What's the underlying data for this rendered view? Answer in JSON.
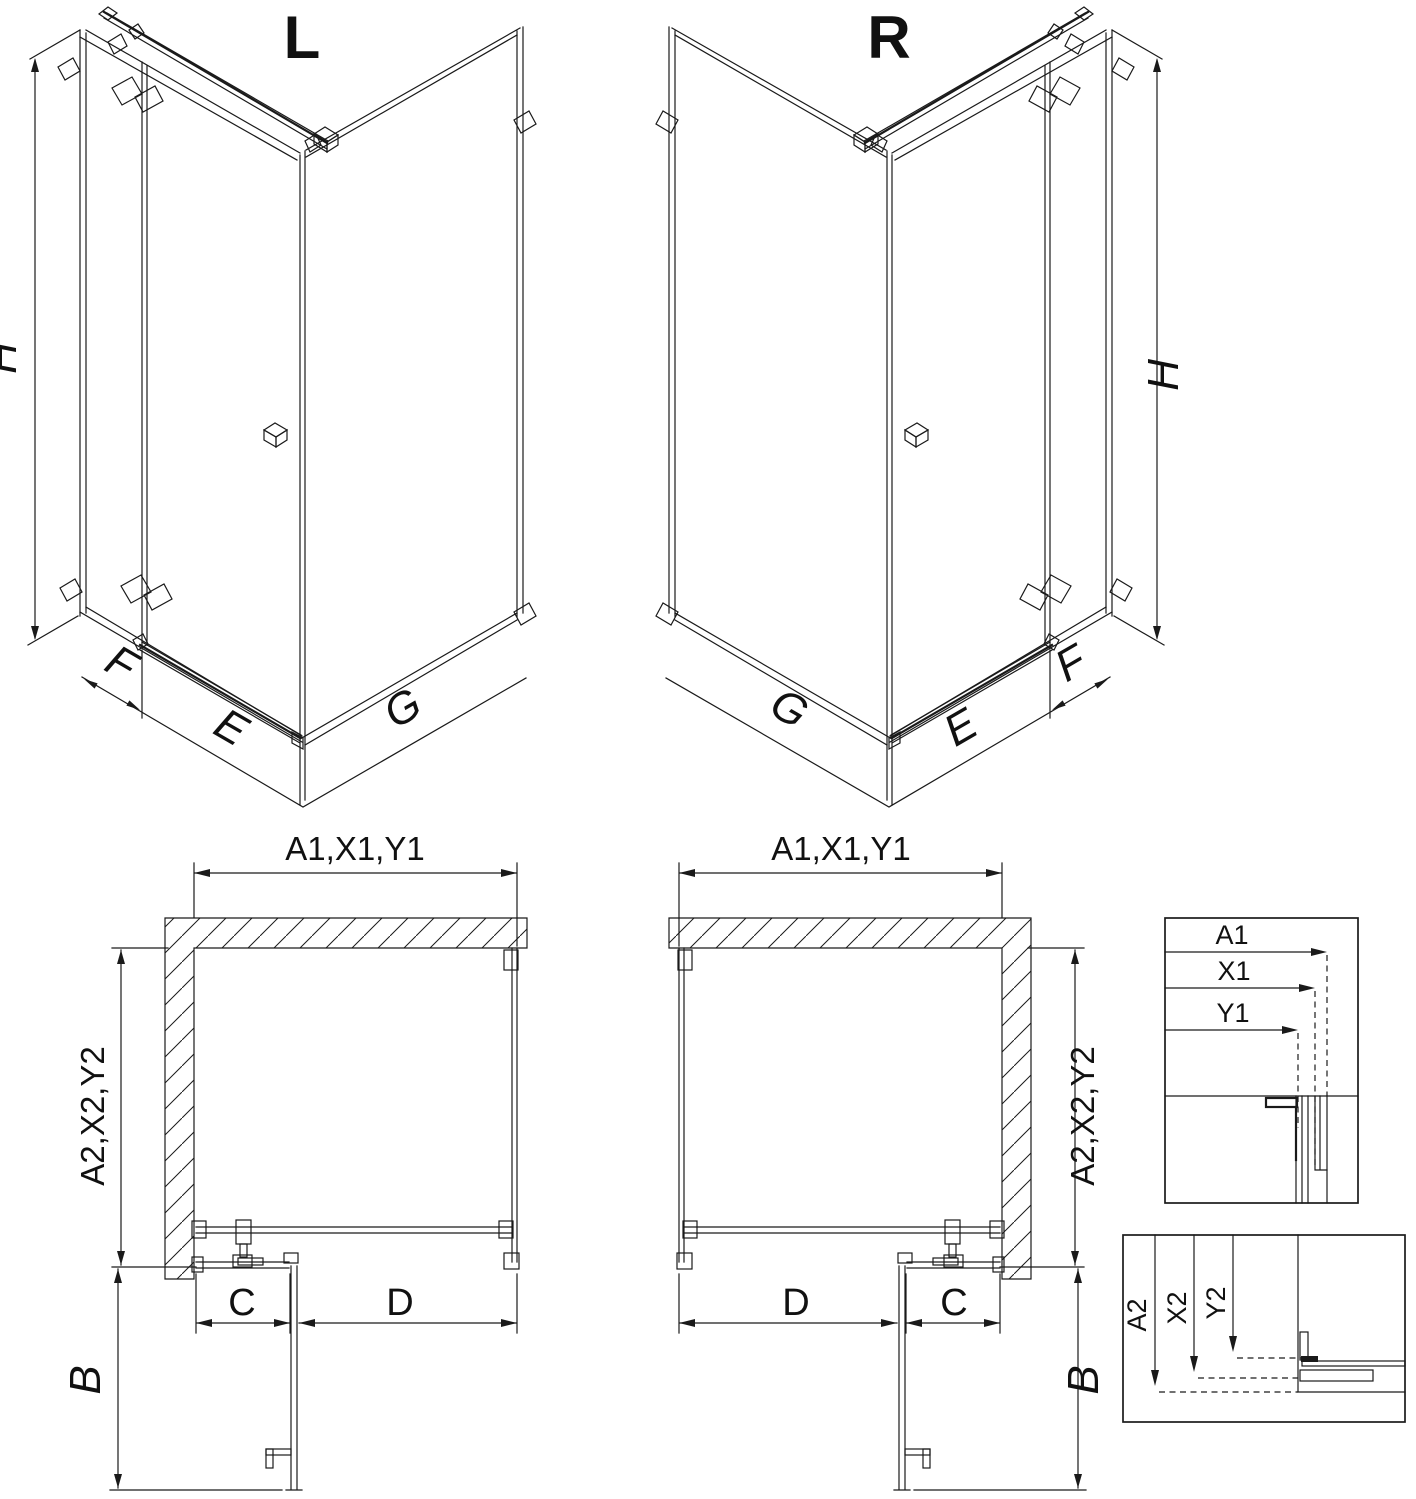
{
  "colors": {
    "line": "#1a1a1a",
    "background": "#ffffff"
  },
  "variants": {
    "left": {
      "title": "L",
      "iso": {
        "height": "H",
        "side_panel": "F",
        "door": "E",
        "return_panel": "G"
      },
      "plan": {
        "width": "A1,X1,Y1",
        "depth": "A2,X2,Y2",
        "fixed": "C",
        "door": "D",
        "swing": "B"
      }
    },
    "right": {
      "title": "R",
      "iso": {
        "height": "H",
        "side_panel": "F",
        "door": "E",
        "return_panel": "G"
      },
      "plan": {
        "width": "A1,X1,Y1",
        "depth": "A2,X2,Y2",
        "fixed": "C",
        "door": "D",
        "swing": "B"
      }
    }
  },
  "details": {
    "width_section": {
      "labels": [
        "A1",
        "X1",
        "Y1"
      ]
    },
    "depth_section": {
      "labels": [
        "A2",
        "X2",
        "Y2"
      ]
    }
  }
}
